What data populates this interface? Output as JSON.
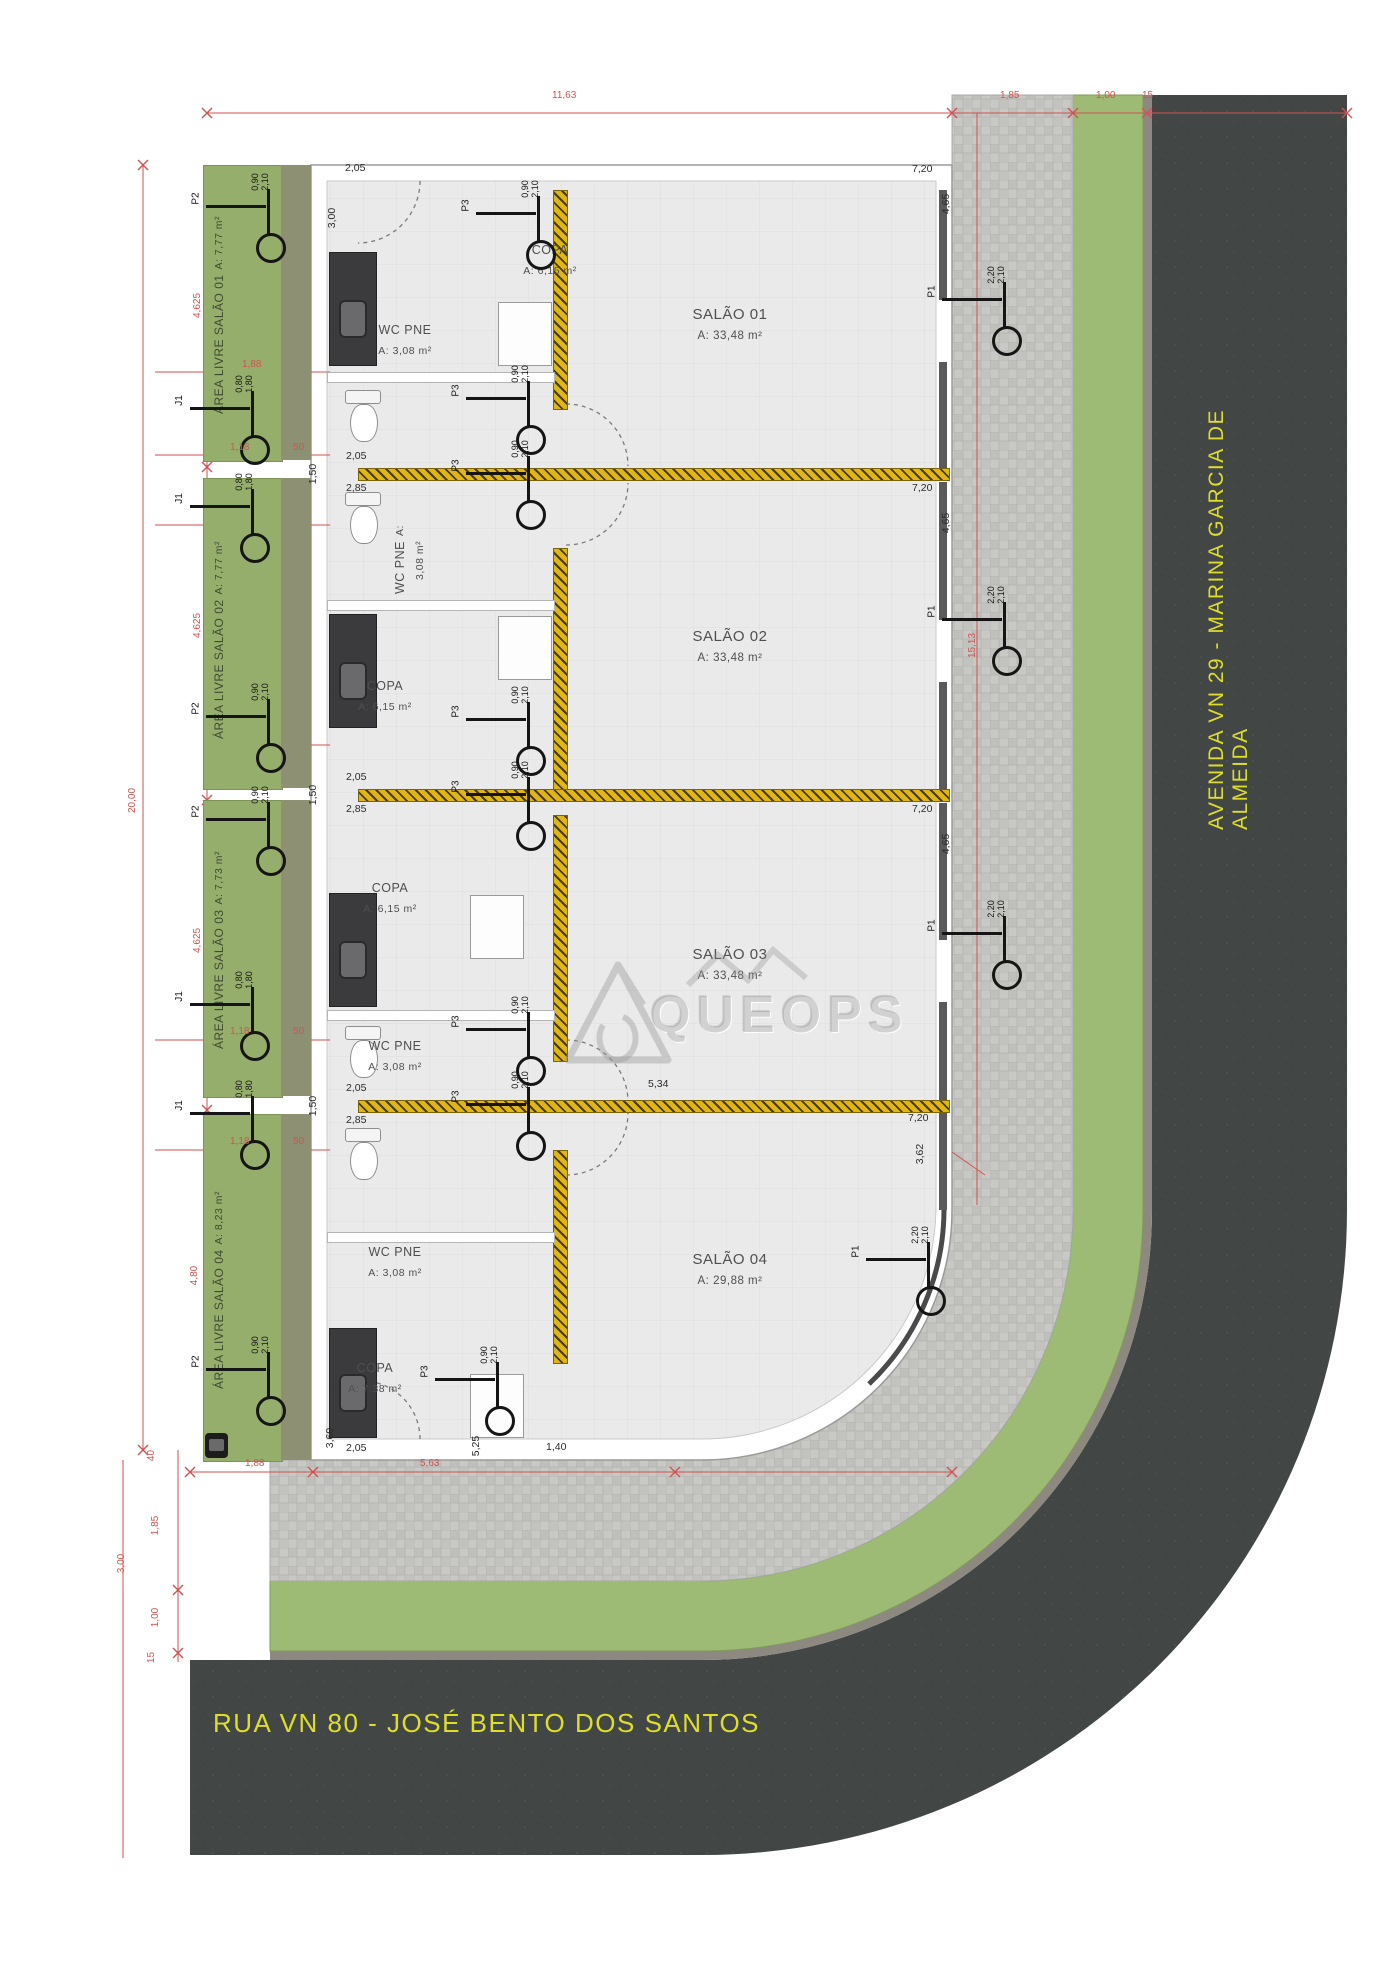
{
  "streets": {
    "avenida": "AVENIDA VN 29 - MARINA GARCIA DE ALMEIDA",
    "rua": "RUA VN 80 - JOSÉ BENTO DOS SANTOS"
  },
  "watermark": "QUEOPS",
  "units": [
    {
      "no": "01",
      "salao": "SALÃO 01",
      "salao_area": "A: 33,48 m²",
      "livre": "ÁREA LIVRE SALÃO 01",
      "livre_area": "A: 7,77 m²",
      "copa": "COPA",
      "copa_area": "A: 6,15 m²",
      "wc": "WC PNE",
      "wc_area": "A: 3,08 m²"
    },
    {
      "no": "02",
      "salao": "SALÃO 02",
      "salao_area": "A: 33,48 m²",
      "livre": "ÁREA LIVRE SALÃO 02",
      "livre_area": "A: 7,77 m²",
      "copa": "COPA",
      "copa_area": "A: 6,15 m²",
      "wc": "WC PNE",
      "wc_area": "A: 3,08 m²"
    },
    {
      "no": "03",
      "salao": "SALÃO 03",
      "salao_area": "A: 33,48 m²",
      "livre": "ÁREA LIVRE SALÃO 03",
      "livre_area": "A: 7,73 m²",
      "copa": "COPA",
      "copa_area": "A: 6,15 m²",
      "wc": "WC PNE",
      "wc_area": "A: 3,08 m²"
    },
    {
      "no": "04",
      "salao": "SALÃO 04",
      "salao_area": "A: 29,88 m²",
      "livre": "ÁREA LIVRE SALÃO 04",
      "livre_area": "A: 8,23 m²",
      "copa": "COPA",
      "copa_area": "A: 7,38 m²",
      "wc": "WC PNE",
      "wc_area": "A: 3,08 m²"
    }
  ],
  "doors": {
    "p1": {
      "label": "P1",
      "w": "2,20",
      "h": "2,10"
    },
    "p2": {
      "label": "P2",
      "w": "0,90",
      "h": "2,10"
    },
    "p3": {
      "label": "P3",
      "w": "0,90",
      "h": "2,10"
    },
    "j1": {
      "label": "J1",
      "w": "0,80",
      "h": "1,80"
    }
  },
  "dims": {
    "w_total": "11,63",
    "w_sidewalk": "1,85",
    "w_green": "1,00",
    "w_curb": "15",
    "h_total": "20,00",
    "h_unit": "4,625",
    "h_unit4": "4,80",
    "g188": "1,88",
    "g118": "1,18",
    "g50": "50",
    "b188": "1,88",
    "b563": "5,63",
    "v40": "40",
    "v185": "1,85",
    "v300": "3,00",
    "v100": "1,00",
    "v15": "15",
    "d205": "2,05",
    "d285": "2,85",
    "d150": "1,50",
    "d300": "3,00",
    "d360": "3,60",
    "d525": "5,25",
    "d140": "1,40",
    "d534": "5,34",
    "d362": "3,62",
    "d720": "7,20",
    "d465": "4,65",
    "d1513": "15,13"
  },
  "colors": {
    "red_dim": "#d15252",
    "road": "#424746",
    "curb": "#8d8880",
    "paver": "#c8c8c4",
    "street_green": "#9dbb74",
    "lot_green": "#96ae6b",
    "sage": "#8d9072",
    "hatch_yellow": "#e0b516",
    "street_text": "#dede2a"
  }
}
